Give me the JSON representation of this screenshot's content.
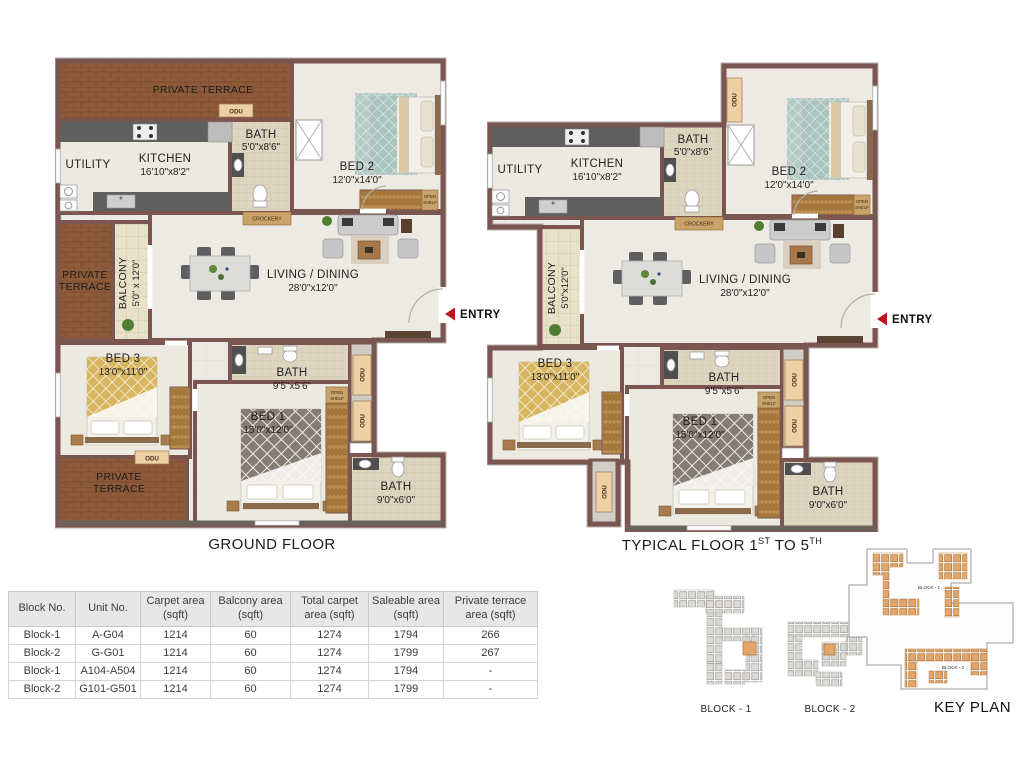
{
  "plans": {
    "ground": {
      "title": "GROUND FLOOR",
      "entry_label": "ENTRY",
      "rooms": {
        "private_terrace_top": {
          "line1": "PRIVATE TERRACE"
        },
        "private_terrace_left": {
          "line1": "PRIVATE",
          "line2": "TERRACE"
        },
        "private_terrace_bottom": {
          "line1": "PRIVATE",
          "line2": "TERRACE"
        },
        "utility": {
          "name": "UTILITY"
        },
        "kitchen": {
          "name": "KITCHEN",
          "dims": "16'10\"x8'2\""
        },
        "bath_top": {
          "name": "BATH",
          "dims": "5'0\"x8'6\""
        },
        "bed2": {
          "name": "BED 2",
          "dims": "12'0\"x14'0\""
        },
        "balcony": {
          "name": "BALCONY",
          "dims": "5'0\" x 12'0\""
        },
        "living": {
          "name": "LIVING / DINING",
          "dims": "28'0\"x12'0\""
        },
        "bed3": {
          "name": "BED 3",
          "dims": "13'0\"x11'0\""
        },
        "bath_mid": {
          "name": "BATH",
          "dims": "9'5\"x5'6\""
        },
        "bed1": {
          "name": "BED 1",
          "dims": "15'0\"x12'0\""
        },
        "bath_bottom": {
          "name": "BATH",
          "dims": "9'0\"x6'0\""
        }
      },
      "tags": {
        "odu": "ODU",
        "crockery": "CROCKERY",
        "open_shelf_1": "OPEN",
        "open_shelf_2": "SHELF"
      }
    },
    "typical": {
      "title_part1": "TYPICAL FLOOR 1",
      "title_sup1": "ST",
      "title_part2": " TO 5",
      "title_sup2": "TH",
      "entry_label": "ENTRY",
      "rooms": {
        "utility": {
          "name": "UTILITY"
        },
        "kitchen": {
          "name": "KITCHEN",
          "dims": "16'10\"x8'2\""
        },
        "bath_top": {
          "name": "BATH",
          "dims": "5'0\"x8'6\""
        },
        "bed2": {
          "name": "BED 2",
          "dims": "12'0\"x14'0\""
        },
        "balcony": {
          "name": "BALCONY",
          "dims": "5'0\"x12'0\""
        },
        "living": {
          "name": "LIVING / DINING",
          "dims": "28'0\"x12'0\""
        },
        "bed3": {
          "name": "BED 3",
          "dims": "13'0\"x11'0\""
        },
        "bath_mid": {
          "name": "BATH",
          "dims": "9'5\"x5'6\""
        },
        "bed1": {
          "name": "BED 1",
          "dims": "15'0\"x12'0\""
        },
        "bath_bottom": {
          "name": "BATH",
          "dims": "9'0\"x6'0\""
        }
      },
      "tags": {
        "odu": "ODU",
        "crockery": "CROCKERY",
        "open_shelf_1": "OPEN",
        "open_shelf_2": "SHELF"
      }
    }
  },
  "area_table": {
    "headers": [
      "Block No.",
      "Unit No.",
      "Carpet area (sqft)",
      "Balcony area (sqft)",
      "Total carpet area (sqft)",
      "Saleable area (sqft)",
      "Private terrace area (sqft)"
    ],
    "rows": [
      {
        "block": "Block-1",
        "unit": "A-G04",
        "carpet": "1214",
        "balcony": "60",
        "total": "1274",
        "saleable": "1794",
        "terrace": "266"
      },
      {
        "block": "Block-2",
        "unit": "G-G01",
        "carpet": "1214",
        "balcony": "60",
        "total": "1274",
        "saleable": "1799",
        "terrace": "267"
      },
      {
        "block": "Block-1",
        "unit": "A104-A504",
        "carpet": "1214",
        "balcony": "60",
        "total": "1274",
        "saleable": "1794",
        "terrace": "-"
      },
      {
        "block": "Block-2",
        "unit": "G101-G501",
        "carpet": "1214",
        "balcony": "60",
        "total": "1274",
        "saleable": "1799",
        "terrace": "-"
      }
    ]
  },
  "key_plan": {
    "block1_label": "BLOCK - 1",
    "block2_label": "BLOCK - 2",
    "title": "KEY PLAN",
    "inner_block1": "BLOCK - 1",
    "inner_block2": "BLOCK - 2"
  },
  "colors": {
    "wall": "#7b5650",
    "terrace_brick": "#8d5b39",
    "floor": "#edeae3",
    "balcony_floor": "#e8e0c8",
    "entry_red": "#c0131c",
    "cluster_orange": "#e2a66c",
    "cluster_gray": "#dcdad6",
    "table_header_bg": "#e7e7e7"
  }
}
